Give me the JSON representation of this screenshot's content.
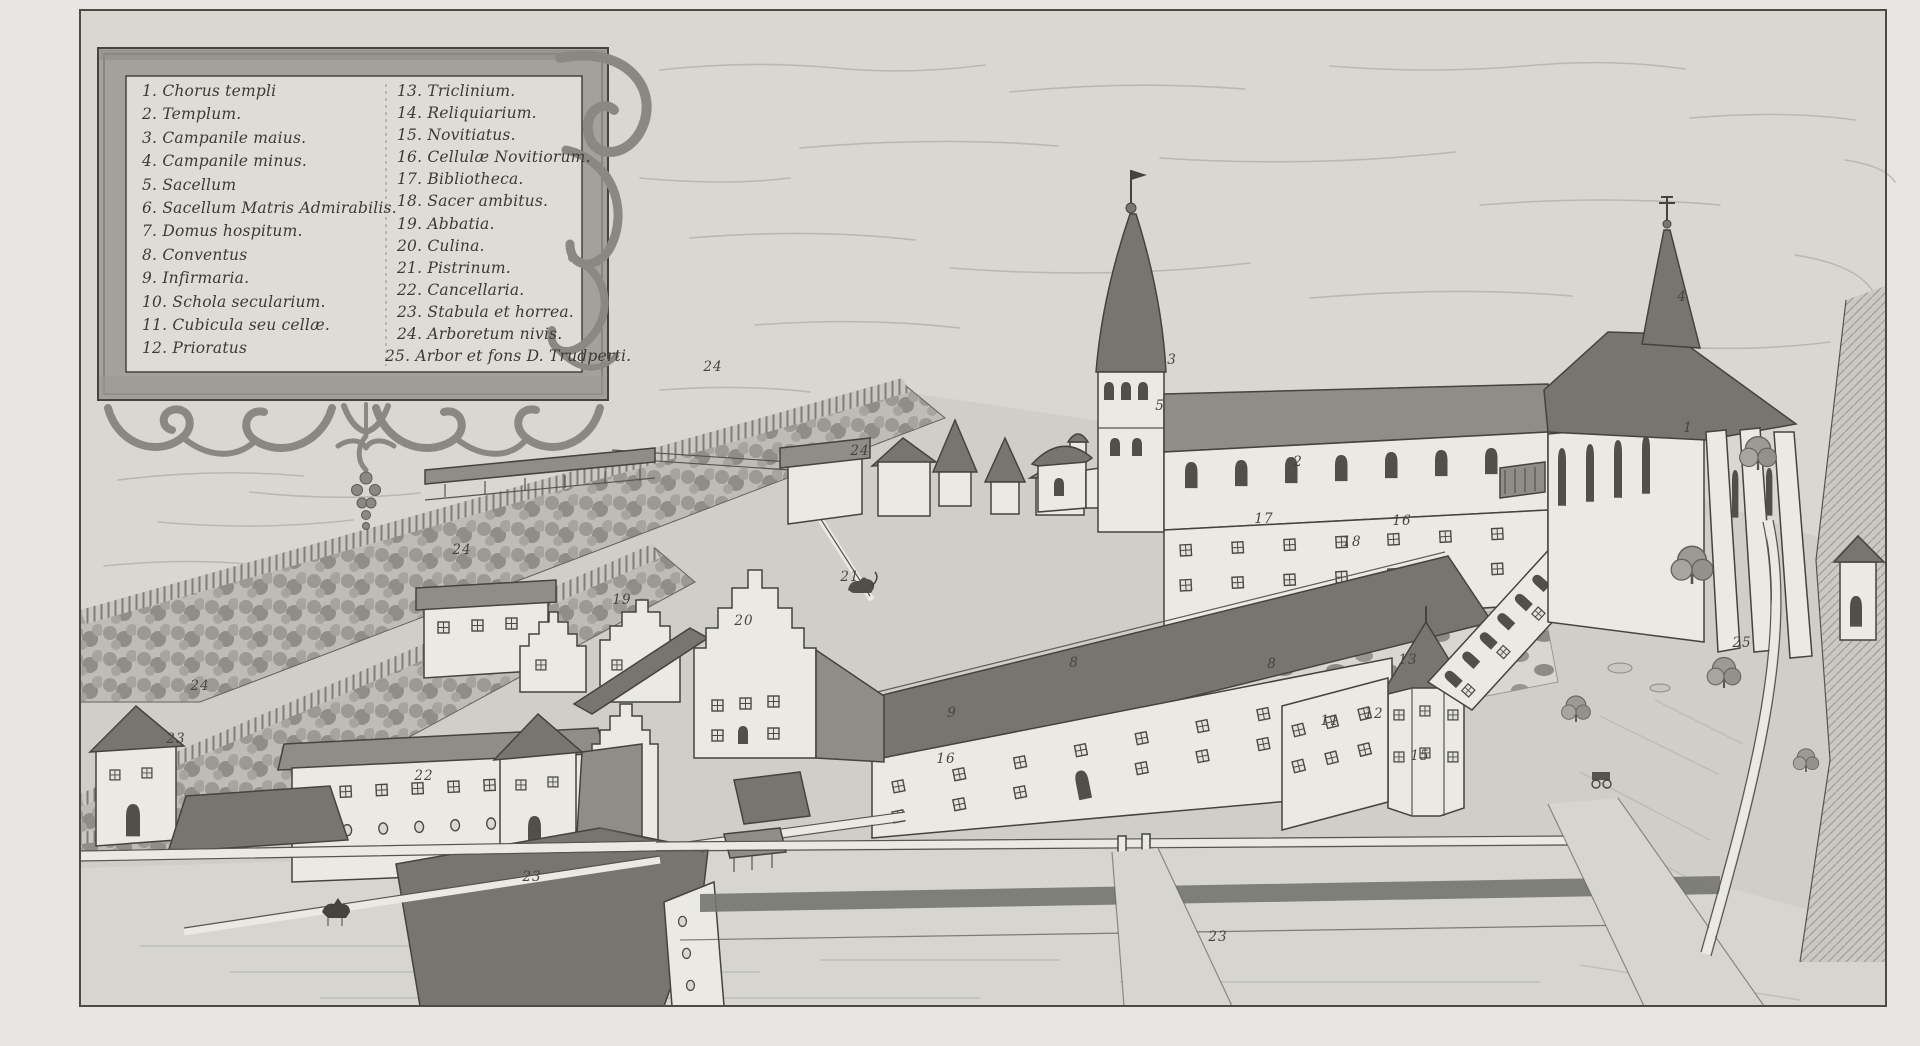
{
  "legend": {
    "columns": [
      {
        "items": [
          "1. Chorus templi",
          "2. Templum.",
          "3. Campanile maius.",
          "4. Campanile minus.",
          "5. Sacellum",
          "6. Sacellum Matris Admirabilis.",
          "7. Domus hospitum.",
          "8. Conventus",
          "9. Infirmaria.",
          "10. Schola secularium.",
          "11. Cubicula seu cellæ.",
          "12. Prioratus"
        ]
      },
      {
        "items": [
          "13. Triclinium.",
          "14. Reliquiarium.",
          "15. Novitiatus.",
          "16. Cellulæ Novitiorum.",
          "17. Bibliotheca.",
          "18. Sacer ambitus.",
          "19. Abbatia.",
          "20. Culina.",
          "21. Pistrinum.",
          "22. Cancellaria.",
          "23. Stabula et horrea.",
          "24. Arboretum nivis.",
          "25. Arbor et fons D. Trudperti."
        ]
      }
    ]
  },
  "plan_labels": [
    {
      "n": "1",
      "x": 1688,
      "y": 428
    },
    {
      "n": "2",
      "x": 1298,
      "y": 462
    },
    {
      "n": "3",
      "x": 1172,
      "y": 360
    },
    {
      "n": "4",
      "x": 1682,
      "y": 297
    },
    {
      "n": "5",
      "x": 1160,
      "y": 406
    },
    {
      "n": "8",
      "x": 1074,
      "y": 663
    },
    {
      "n": "8",
      "x": 1272,
      "y": 664
    },
    {
      "n": "9",
      "x": 952,
      "y": 713
    },
    {
      "n": "11",
      "x": 1330,
      "y": 721
    },
    {
      "n": "12",
      "x": 1374,
      "y": 714
    },
    {
      "n": "13",
      "x": 1408,
      "y": 660
    },
    {
      "n": "15",
      "x": 1420,
      "y": 756
    },
    {
      "n": "16",
      "x": 946,
      "y": 759
    },
    {
      "n": "16",
      "x": 1402,
      "y": 521
    },
    {
      "n": "17",
      "x": 1264,
      "y": 519
    },
    {
      "n": "18",
      "x": 1352,
      "y": 542
    },
    {
      "n": "19",
      "x": 622,
      "y": 600
    },
    {
      "n": "20",
      "x": 744,
      "y": 621
    },
    {
      "n": "21",
      "x": 850,
      "y": 577
    },
    {
      "n": "22",
      "x": 424,
      "y": 776
    },
    {
      "n": "23",
      "x": 176,
      "y": 739
    },
    {
      "n": "23",
      "x": 532,
      "y": 877
    },
    {
      "n": "23",
      "x": 1218,
      "y": 937
    },
    {
      "n": "24",
      "x": 713,
      "y": 367
    },
    {
      "n": "24",
      "x": 860,
      "y": 451
    },
    {
      "n": "24",
      "x": 462,
      "y": 550
    },
    {
      "n": "24",
      "x": 200,
      "y": 686
    },
    {
      "n": "25",
      "x": 1742,
      "y": 643
    }
  ],
  "palette": {
    "paperOuter": "#e7e6e2",
    "paper": "#d8d7d2",
    "panel": "#dedcd6",
    "ink": "#44433e",
    "wall": "#ebe9e3",
    "wallshade": "#c7c6c0",
    "roof": "#8e8d87",
    "roofdark": "#767570",
    "ground": "#cfcec8",
    "ground2": "#d6d5cf",
    "cloud": "#b6b5b0",
    "band": "#a3a19b",
    "ornament": "#8a8981"
  }
}
